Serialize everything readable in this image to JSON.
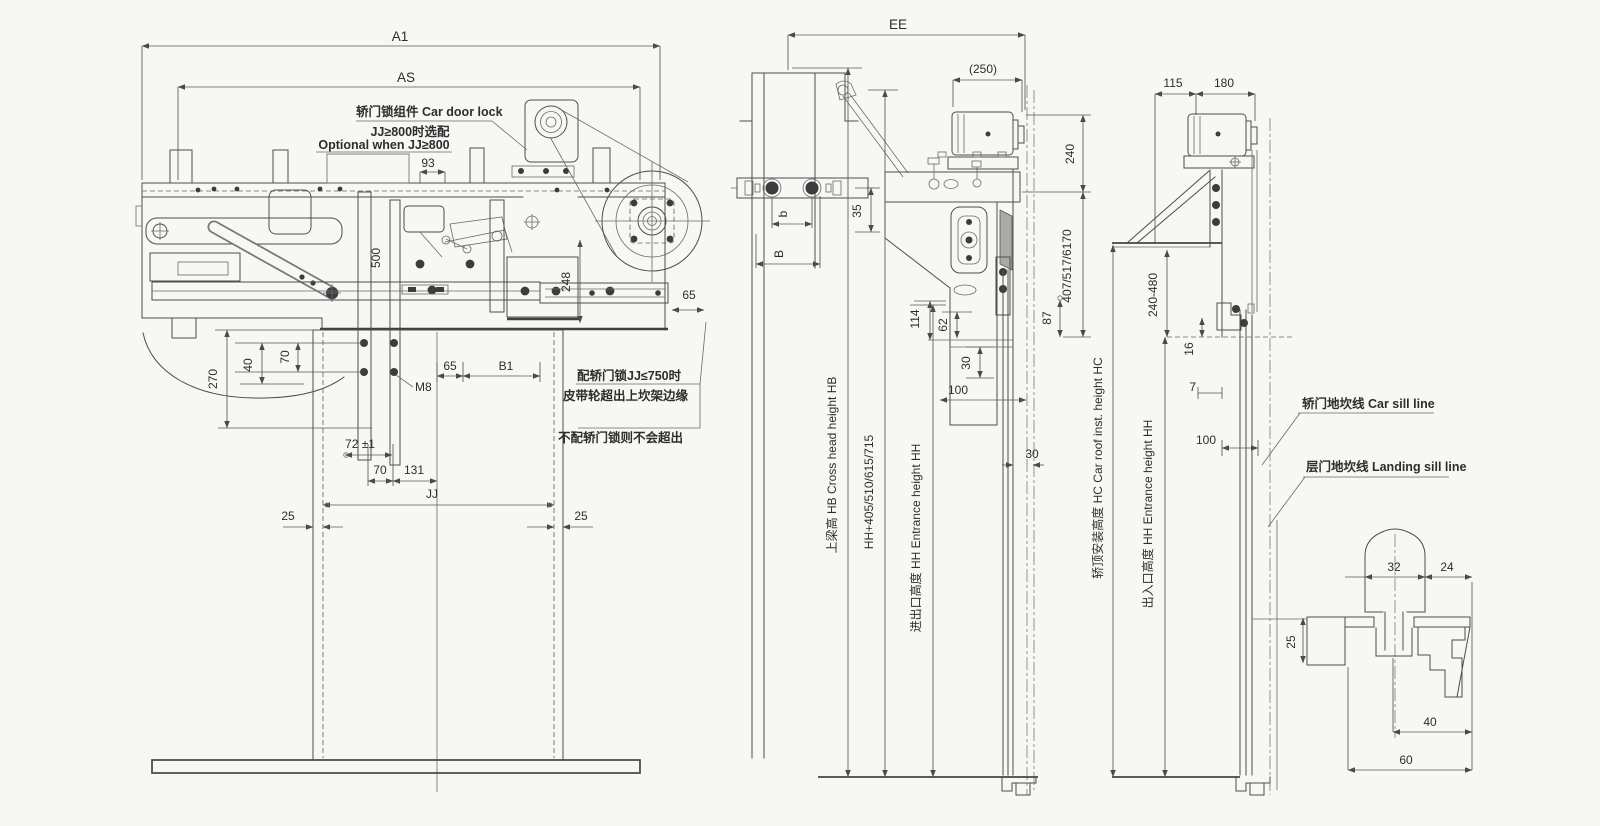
{
  "meta": {
    "sheet_bg": "#f7f7f4",
    "line_color": "#4e4e4e",
    "text_color": "#2d2d2d"
  },
  "front_view": {
    "dim_A1": "A1",
    "dim_AS": "AS",
    "note_lock": "轿门锁组件 Car door lock",
    "note_optional_cn": "JJ≥800时选配",
    "note_optional_en": "Optional when JJ≥800",
    "dim_93": "93",
    "dim_500": "500",
    "dim_248": "248",
    "dim_65_belt": "65",
    "dim_270": "270",
    "dim_40": "40",
    "dim_70_upper": "70",
    "label_M8": "M8",
    "dim_65_track": "65",
    "dim_B1": "B1",
    "dim_72": "72 ±1",
    "dim_70_lower": "70",
    "dim_131": "131",
    "dim_JJ": "JJ",
    "dim_25_left": "25",
    "dim_25_right": "25",
    "note_belt_line1": "配轿门锁JJ≤750时",
    "note_belt_line2": "皮带轮超出上坎架边缘",
    "note_belt_line3": "不配轿门锁则不会超出"
  },
  "crosshead_view": {
    "dim_EE": "EE",
    "dim_250": "(250)",
    "dim_b": "b",
    "dim_B": "B",
    "dim_35": "35",
    "dim_240": "240",
    "dim_407": "407/517/6170",
    "dim_114": "114",
    "dim_62": "62",
    "dim_30_vertical": "30",
    "dim_100": "100",
    "dim_87": "87",
    "dim_30_horizontal": "30",
    "label_crosshead": "上梁高 HB Cross head height HB",
    "label_hh_plus": "HH+405/510/615/715",
    "label_entrance": "进出口高度 HH Entrance height HH"
  },
  "car_roof_view": {
    "dim_115": "115",
    "dim_180": "180",
    "dim_240_480": "240-480",
    "dim_16": "16",
    "dim_7": "7",
    "dim_100": "100",
    "label_car_roof": "轿顶安装高度 HC Car roof inst. height HC",
    "label_entrance": "出入口高度 HH Entrance height HH",
    "label_car_sill_line": "轿门地坎线 Car sill line",
    "label_landing_sill_line": "层门地坎线 Landing sill line"
  },
  "sill_detail": {
    "dim_32": "32",
    "dim_24": "24",
    "dim_25": "25",
    "dim_40": "40",
    "dim_60": "60"
  }
}
